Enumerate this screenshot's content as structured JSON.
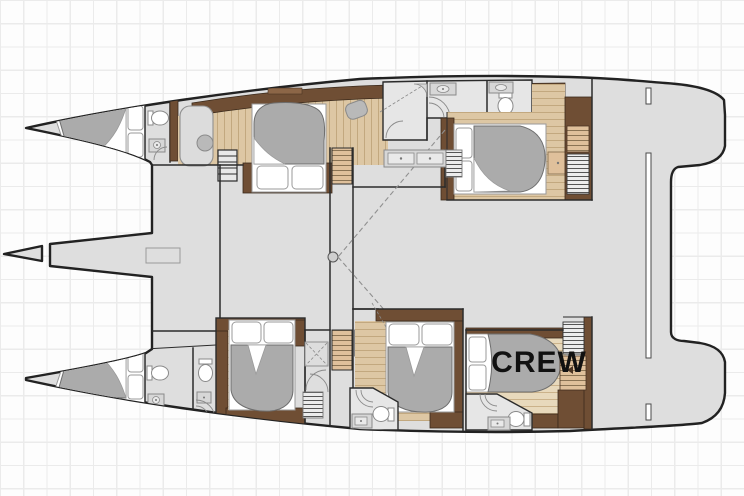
{
  "labels": {
    "crew_cabin": "CREW"
  },
  "colors": {
    "page_bg": "#fdfdfd",
    "grid": "#ebebeb",
    "outline": "#222222",
    "wall": "#2b2b2b",
    "deck": "#dedede",
    "room": "#e6e6e6",
    "wood": "#ddc7a4",
    "wood_line": "#c2a87f",
    "wood_light": "#e8d9bc",
    "tan_step": "#dfc09b",
    "brown_dark": "#6f4e34",
    "brown_mid": "#8c6647",
    "duvet": "#ababab",
    "fixture": "#8a8a8a",
    "dash": "#909090",
    "label": "#111111"
  }
}
